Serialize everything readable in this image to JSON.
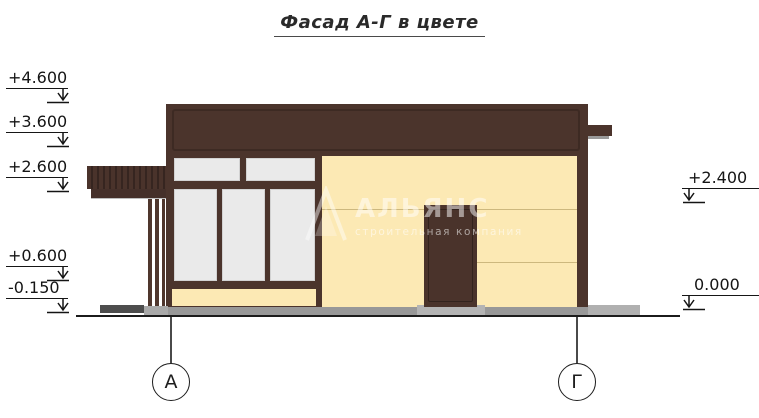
{
  "title": "Фасад А-Г в цвете",
  "markers": {
    "left": [
      {
        "value": "+4.600"
      },
      {
        "value": "+3.600"
      },
      {
        "value": "+2.600"
      },
      {
        "value": "+0.600"
      },
      {
        "value": "-0.150"
      }
    ],
    "right": [
      {
        "value": "+2.400"
      },
      {
        "value": "0.000"
      }
    ]
  },
  "axes": {
    "left": {
      "label": "А"
    },
    "right": {
      "label": "Г"
    }
  },
  "watermark": {
    "name": "АЛЬЯНС",
    "tagline": "строительная компания"
  },
  "colors": {
    "dark_brown": "#4b342c",
    "wall_cream": "#fce9b4",
    "glass_gray": "#eaeaea",
    "ground_gray": "#989898",
    "seam": "#cdb87e",
    "ground_line": "#1b1b1b"
  }
}
